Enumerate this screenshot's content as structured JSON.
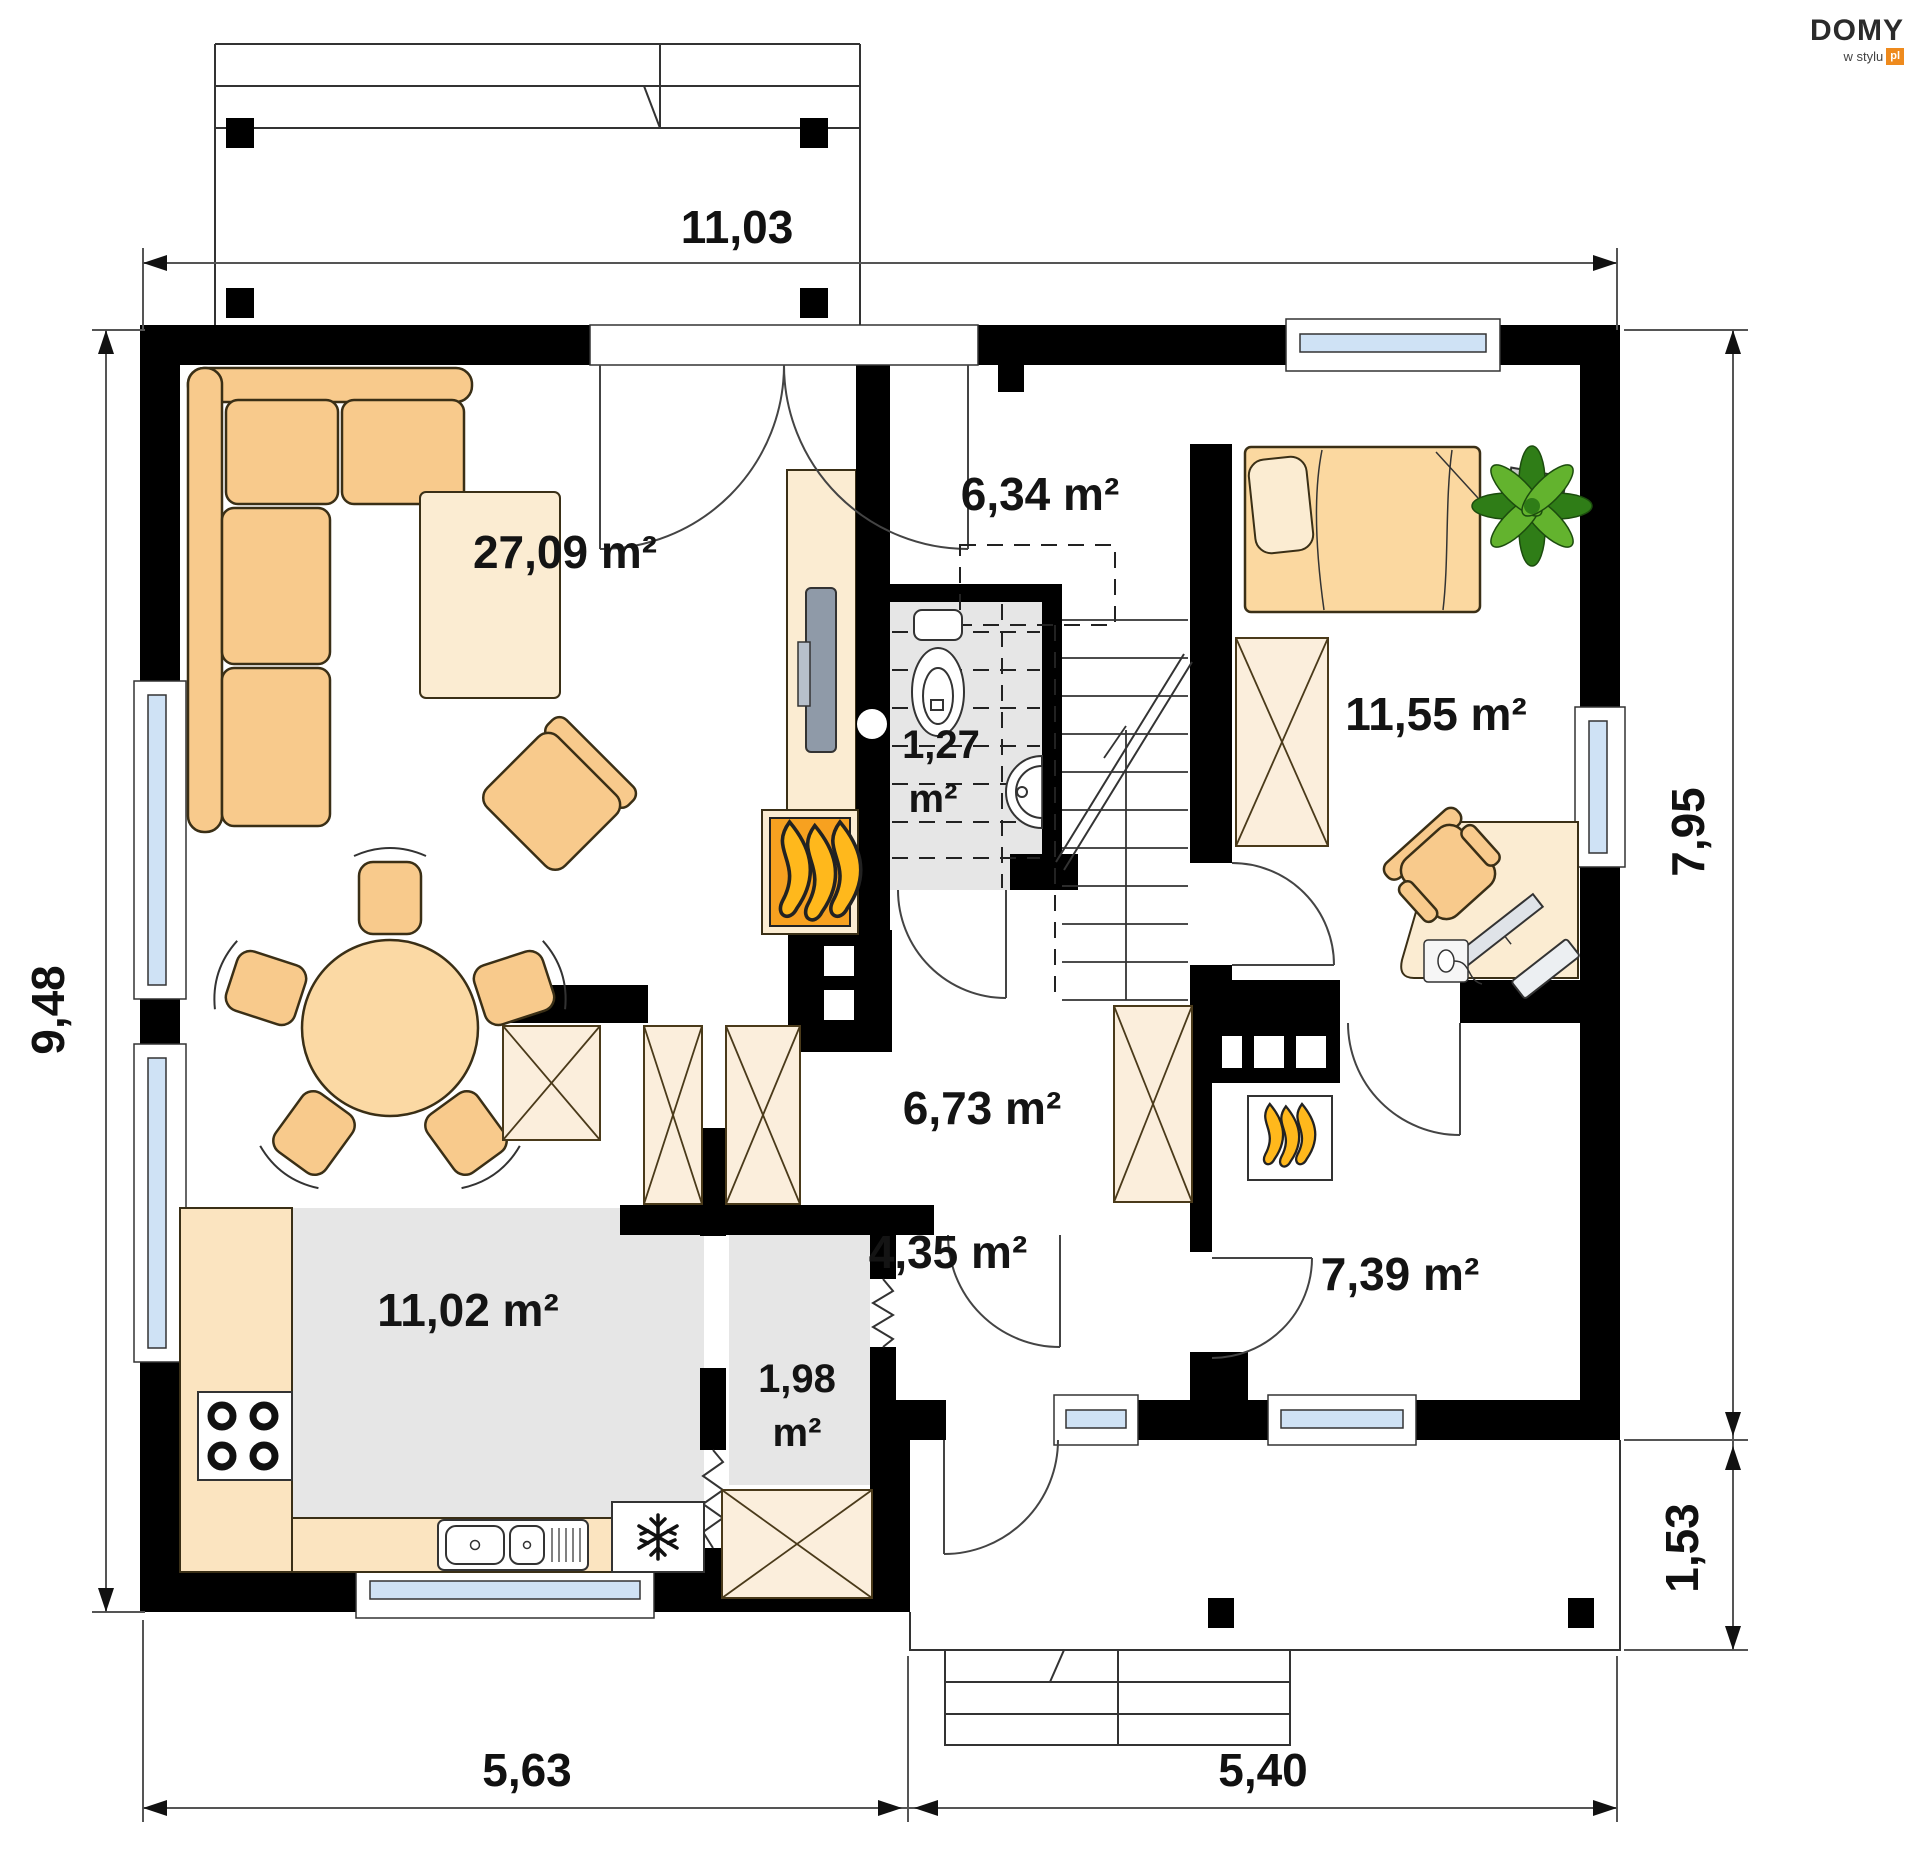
{
  "logo": {
    "brand": "DOMY",
    "tagline": "w stylu",
    "tld": "pl"
  },
  "dimensions": {
    "top": "11,03",
    "left": "9,48",
    "right_upper": "7,95",
    "right_lower": "1,53",
    "bottom_left": "5,63",
    "bottom_right": "5,40"
  },
  "rooms": {
    "living": {
      "area_label": "27,09 m²"
    },
    "staircase": {
      "area_label": "6,34 m²"
    },
    "wc": {
      "area_line1": "1,27",
      "area_line2": "m²"
    },
    "bedroom": {
      "area_label": "11,55 m²"
    },
    "hall": {
      "area_label": "6,73 m²"
    },
    "kitchen": {
      "area_label": "11,02 m²"
    },
    "pantry": {
      "area_line1": "1,98",
      "area_line2": "m²"
    },
    "vestibule": {
      "area_label": "4,35 m²"
    },
    "utility": {
      "area_label": "7,39 m²"
    }
  },
  "colors": {
    "wall": "#000000",
    "furniture_tan": "#f8ca8c",
    "furniture_light": "#fbe4c0",
    "floor_gray": "#e6e6e6",
    "window_glass": "#cfe2f5",
    "flame_orange": "#ffb81c",
    "fireplace_orange": "#f7a120",
    "plant_green": "#3f9621",
    "logo_orange": "#ee8a1d"
  }
}
